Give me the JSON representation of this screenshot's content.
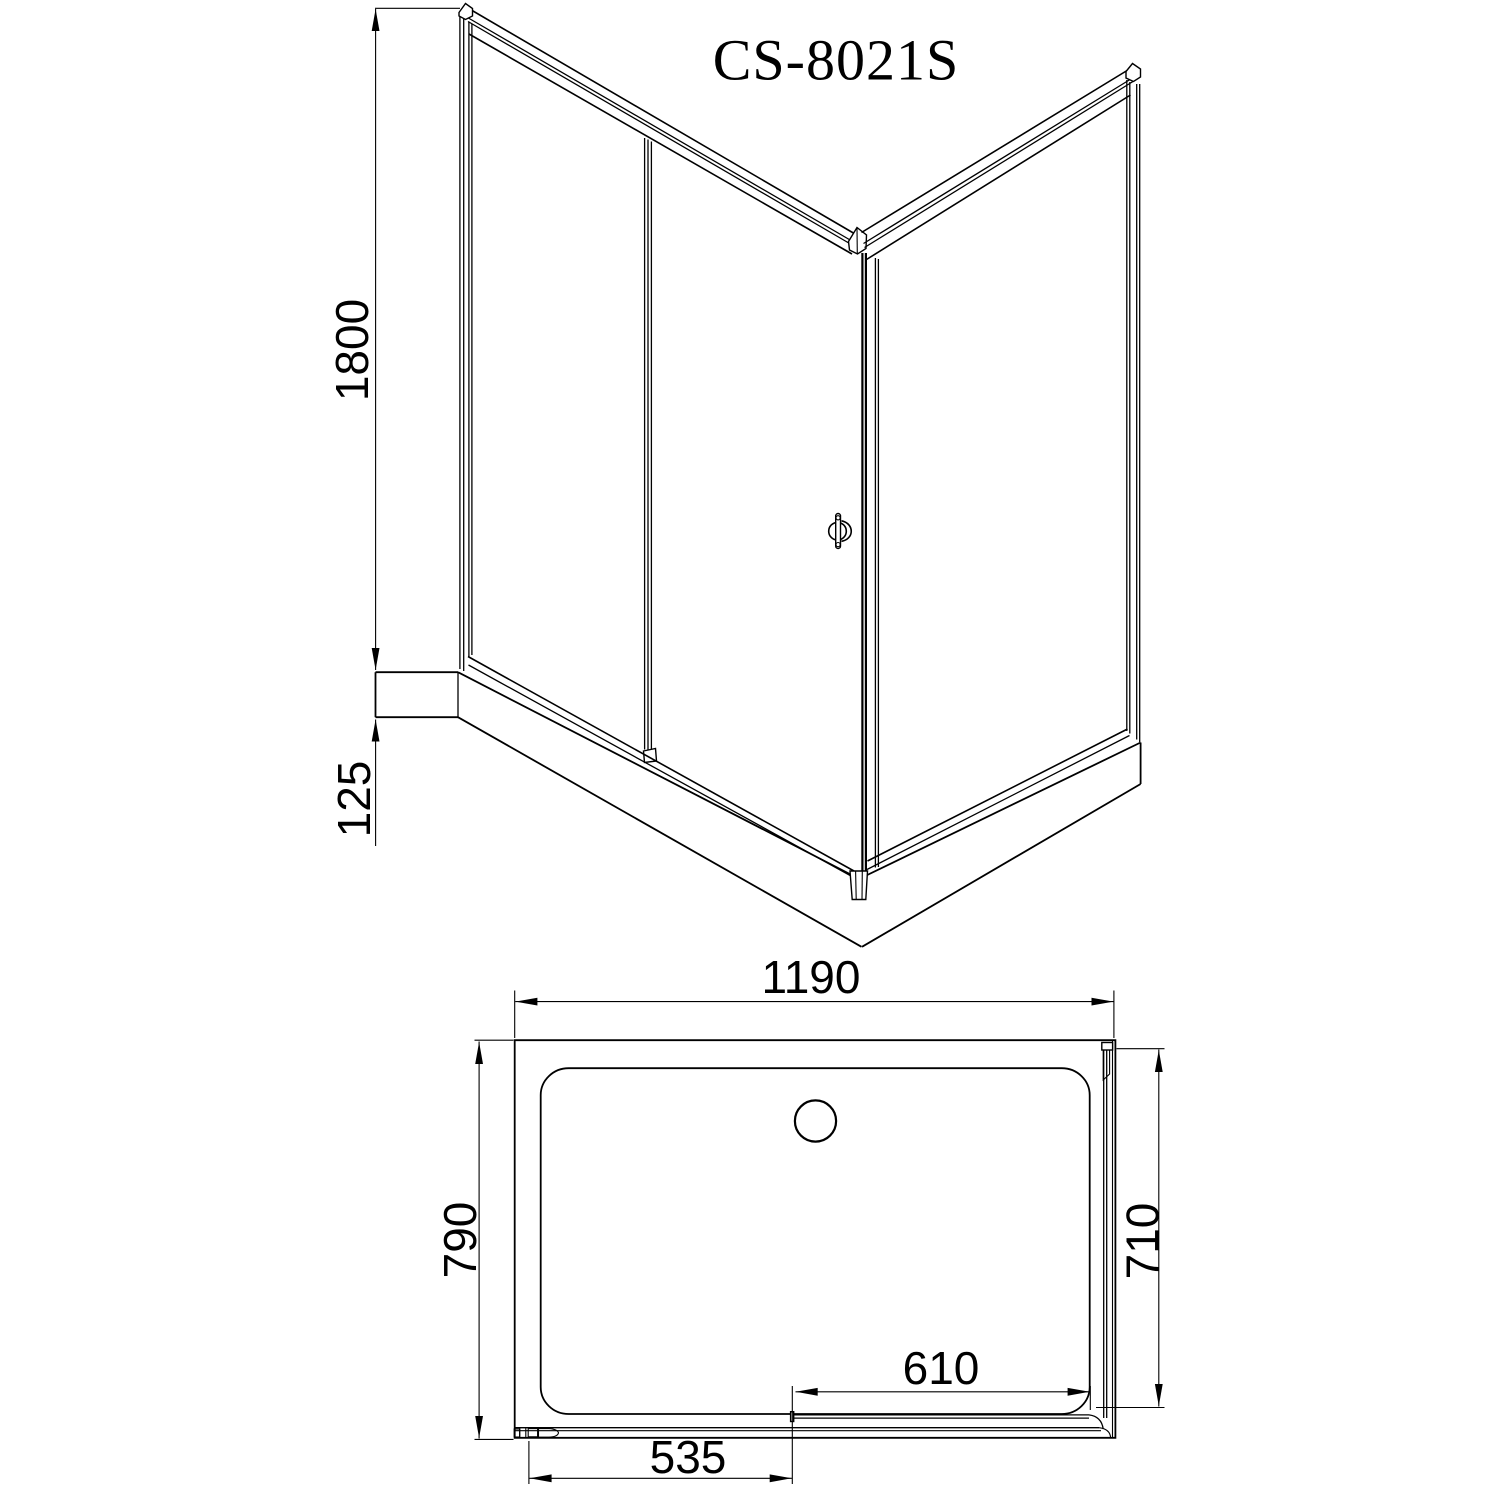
{
  "title": "CS-8021S",
  "colors": {
    "line": "#000000",
    "background": "#ffffff"
  },
  "elevation_view": {
    "description": "corner shower enclosure, front perspective line drawing",
    "dimensions": {
      "height": "1800",
      "tray_height": "125"
    }
  },
  "plan_view": {
    "description": "shower tray top plan view with sliding door",
    "dimensions": {
      "width": "1190",
      "depth": "790",
      "side_return": "710",
      "door_opening": "610",
      "door_panel": "535"
    }
  }
}
